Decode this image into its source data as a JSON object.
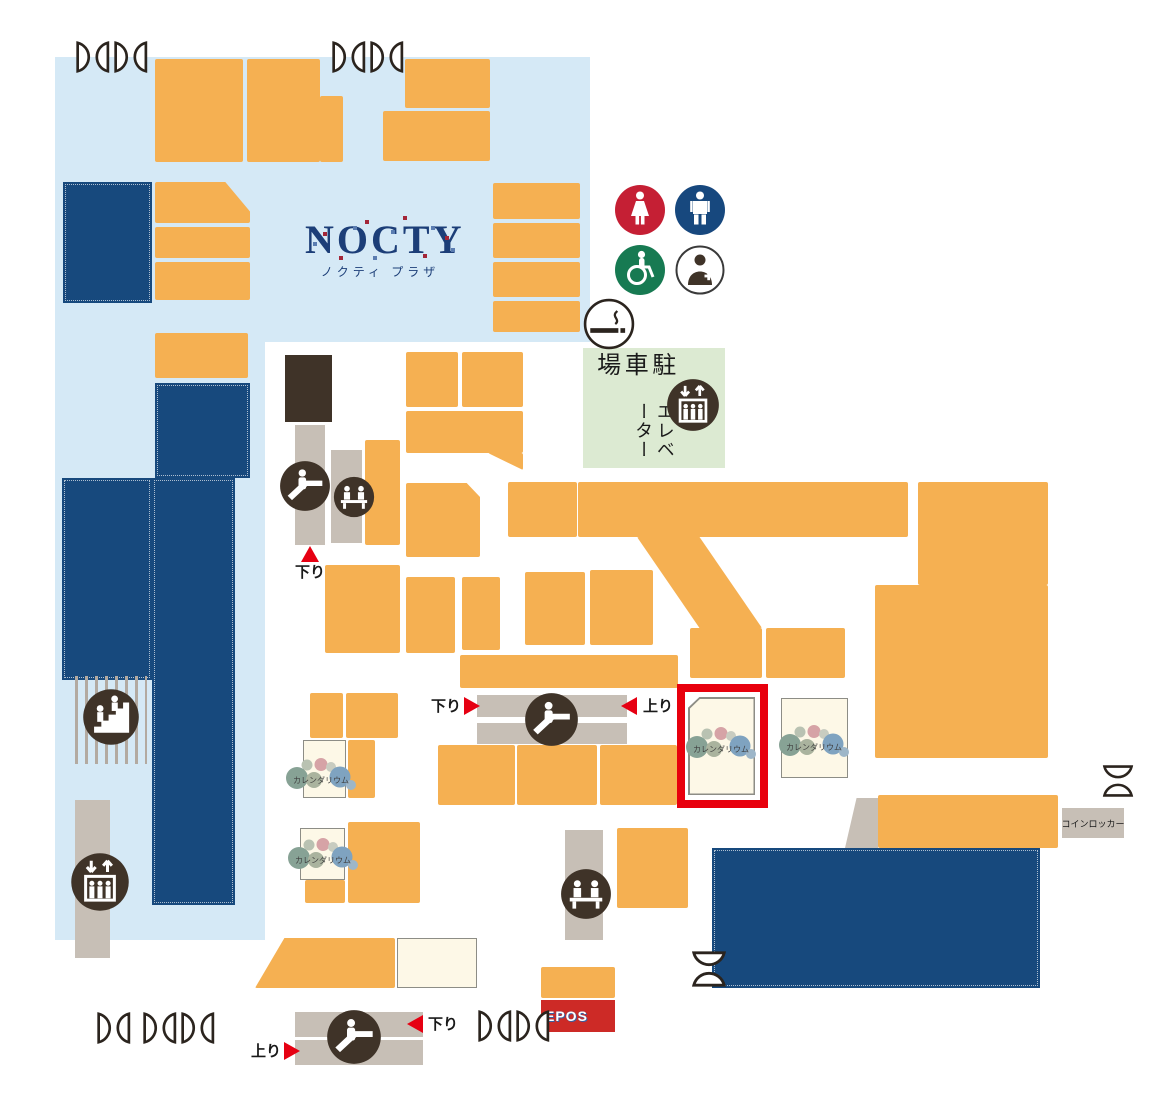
{
  "map": {
    "title": "NOCTY",
    "subtitle": "ノクティ プラザ",
    "parking": {
      "line1": "駐車場",
      "line2": "エレベーター"
    },
    "labels": {
      "down": "下り",
      "up": "上り",
      "coin_locker": "コインロッカー",
      "epos": "EPOS"
    },
    "shop_logo_text": "カレンダリウム"
  },
  "icons": {
    "women-restroom": "red circle with dress figure",
    "men-restroom": "navy circle with standing figure",
    "wheelchair-accessible": "green circle with wheelchair",
    "first-aid-room": "outlined circle with attendant and cross",
    "smoking-area": "outlined circle with cigarette",
    "escalator": "dark circle with person on escalator",
    "elevator": "dark circle with cab, riders and up-down arrows",
    "stairs": "dark circle with people on steps",
    "rest-bench": "dark circle with two seated people",
    "door": "double swing-door plan symbol"
  },
  "colors": {
    "building": "#d5e9f6",
    "shop": "#f5b052",
    "anchor": "#17497d",
    "facility": "#c7bfb6",
    "icon_dark": "#3f3328",
    "parking_bg": "#dcead2",
    "vacant": "#fdf8e7",
    "highlight": "#e8000d",
    "triangle": "#e60012",
    "women": "#c51f34",
    "men": "#17487e",
    "wheelchair": "#177a52",
    "epos": "#cd2a26",
    "door": "#2b241e",
    "text": "#1a1a1a",
    "logo_navy": "#1c3e78"
  }
}
